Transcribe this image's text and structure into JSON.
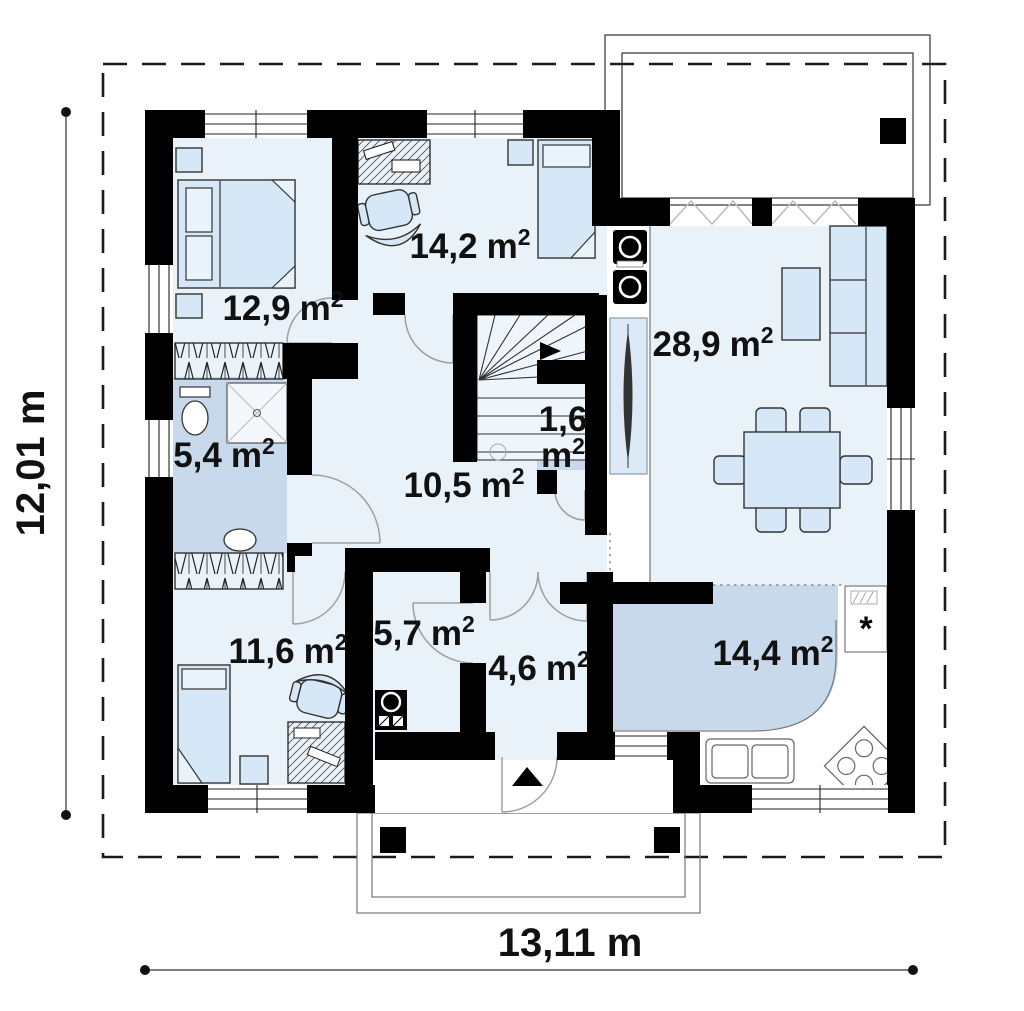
{
  "page": {
    "title": "House floor plan — ground floor"
  },
  "plan": {
    "wall_color": "#000000",
    "room_fill": "#eaf2f9",
    "wet_room_fill": "#c9d9ec",
    "furniture_fill": "#d6e8f7",
    "area_unit": {
      "base": "m",
      "exponent": "2"
    },
    "icons": {
      "freezer": "*"
    },
    "rooms": [
      {
        "id": "bedroom-1",
        "area": "12,9",
        "label_x": 283,
        "label_y": 320
      },
      {
        "id": "study-bedroom",
        "area": "14,2",
        "label_x": 470,
        "label_y": 258
      },
      {
        "id": "living-dining-room",
        "area": "28,9",
        "label_x": 713,
        "label_y": 356
      },
      {
        "id": "bathroom",
        "area": "5,4",
        "label_x": 224,
        "label_y": 467
      },
      {
        "id": "wc",
        "area": "1,6",
        "label_x": 563,
        "label_y": 431,
        "two_line": true,
        "label_y2": 467
      },
      {
        "id": "hall",
        "area": "10,5",
        "label_x": 464,
        "label_y": 497
      },
      {
        "id": "bedroom-2",
        "area": "11,6",
        "label_x": 288,
        "label_y": 663
      },
      {
        "id": "utility-room",
        "area": "5,7",
        "label_x": 424,
        "label_y": 645
      },
      {
        "id": "entry-hall",
        "area": "4,6",
        "label_x": 539,
        "label_y": 680
      },
      {
        "id": "kitchen",
        "area": "14,4",
        "label_x": 773,
        "label_y": 665
      }
    ],
    "dimensions": {
      "side_label": "12,01 m",
      "bottom_label": "13,11 m"
    }
  }
}
